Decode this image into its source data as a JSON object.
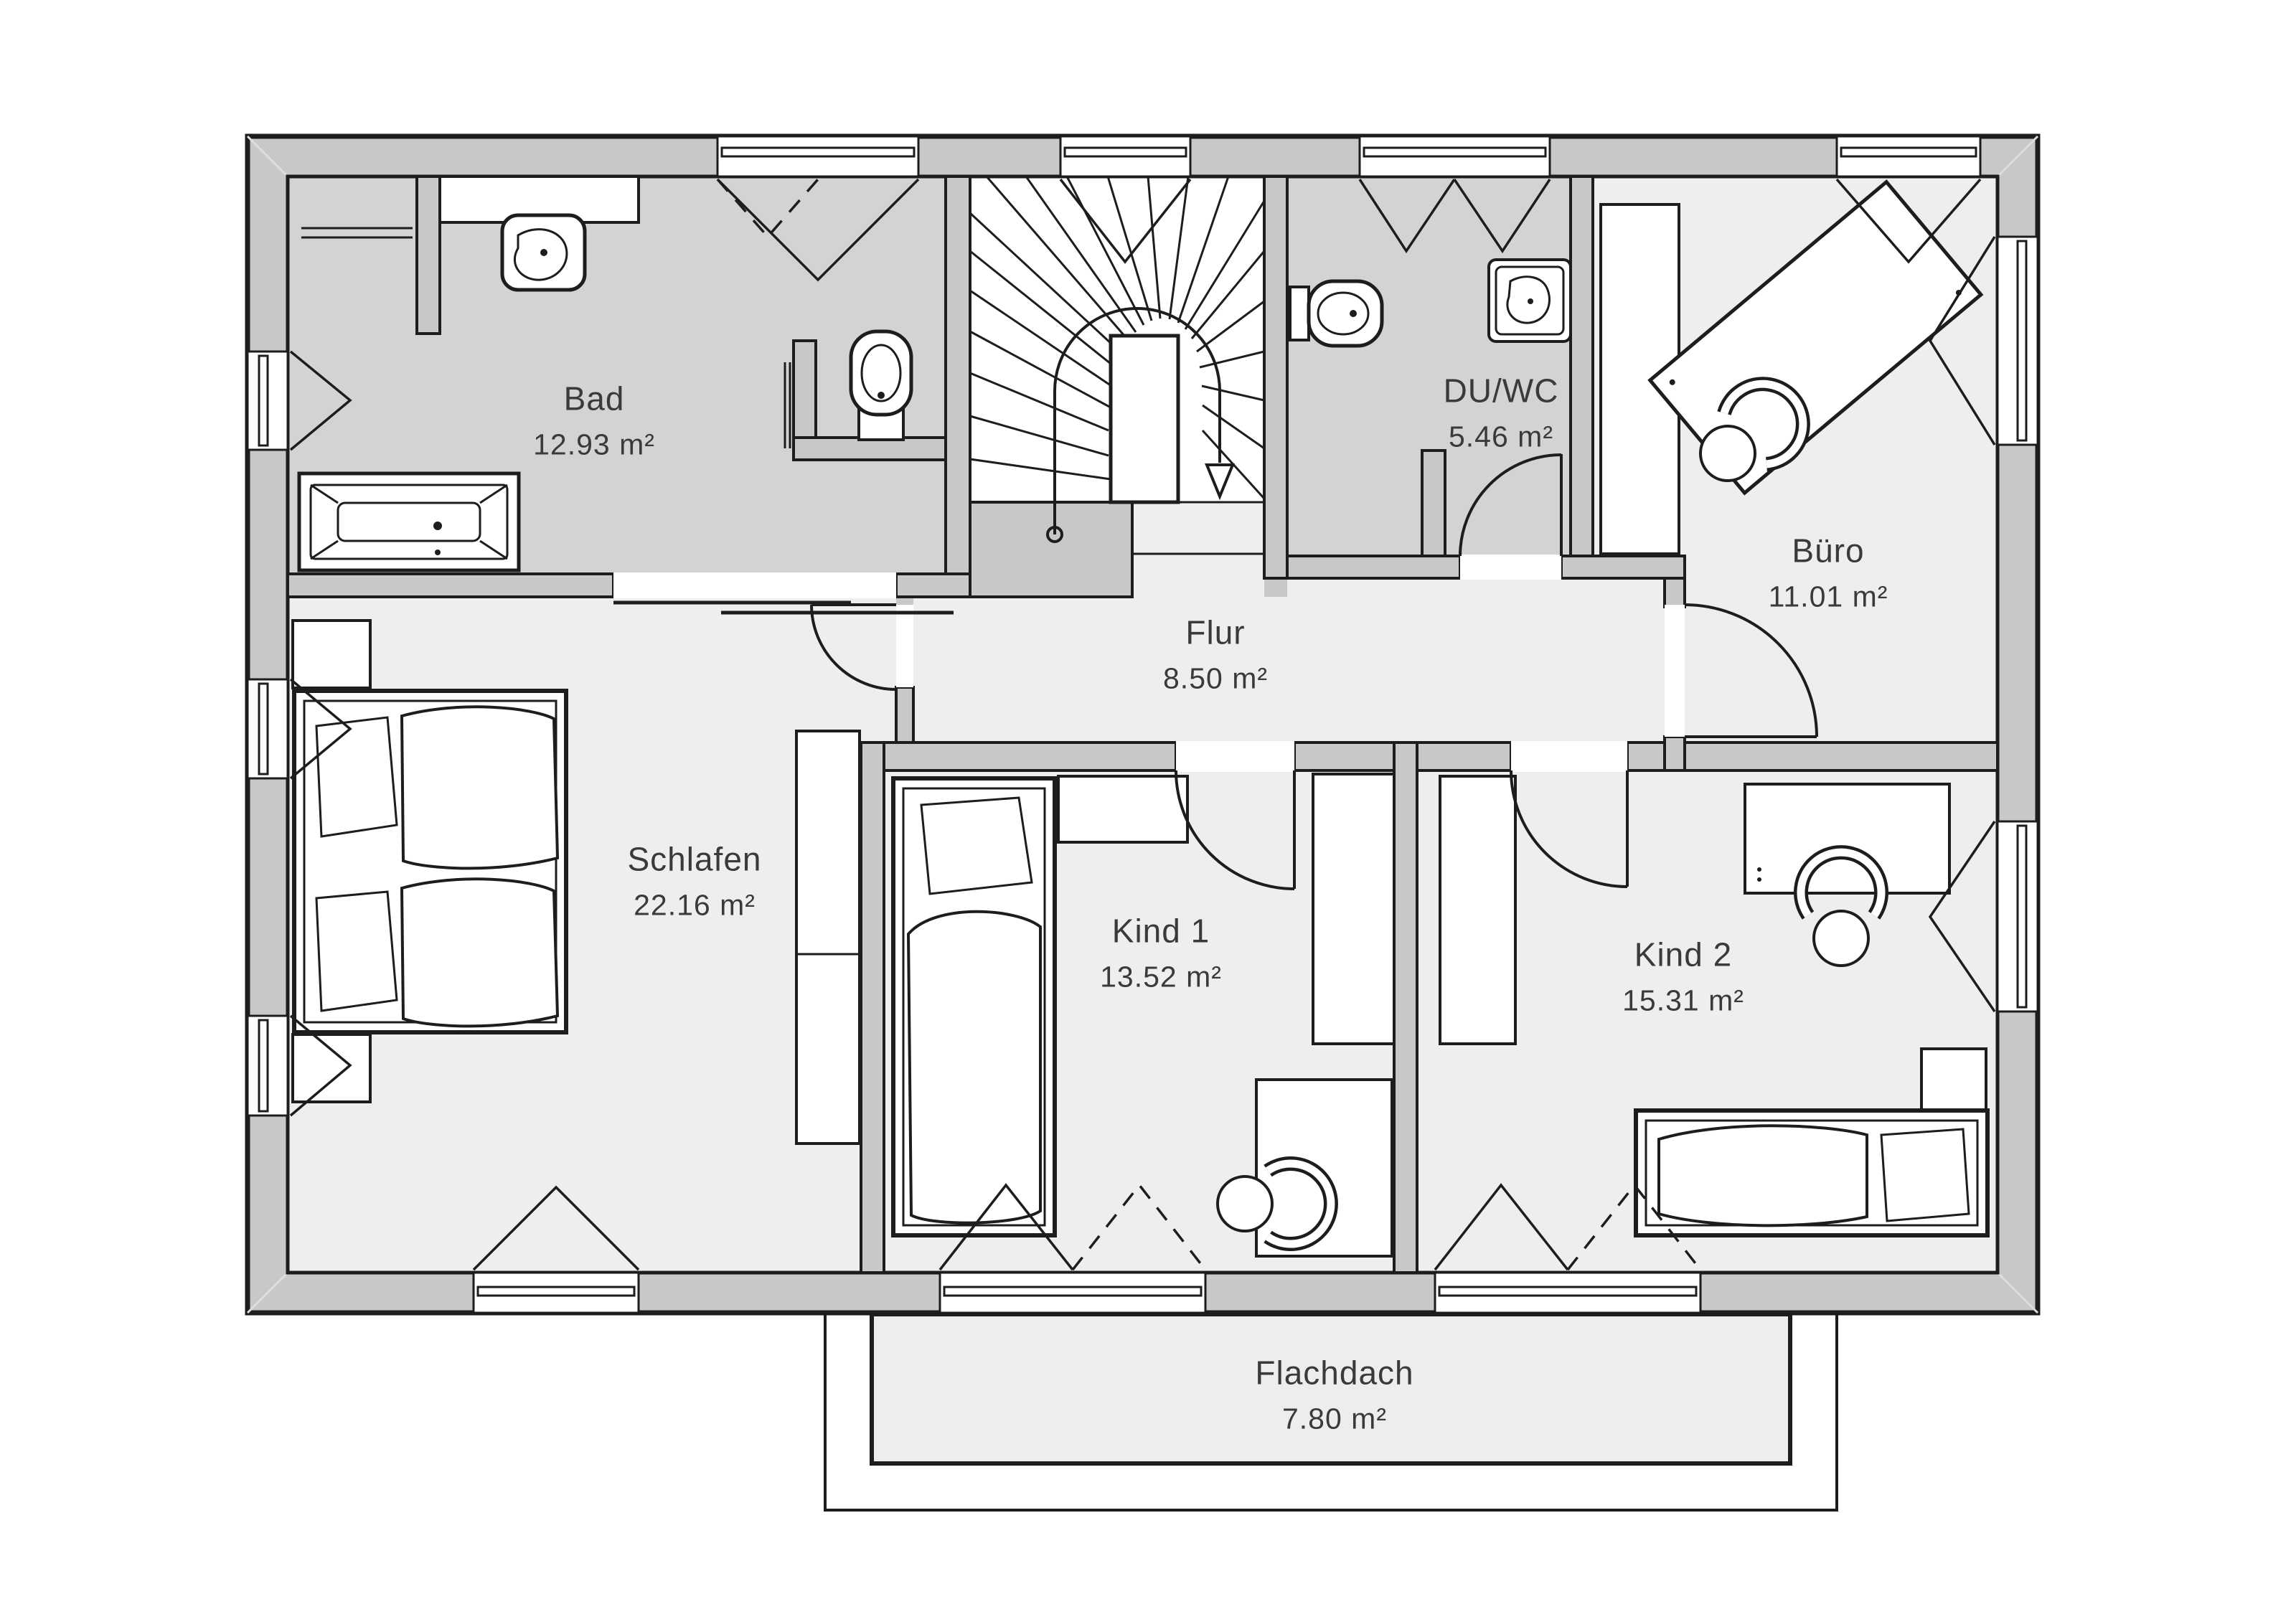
{
  "plan": {
    "type": "floor-plan",
    "language": "de",
    "colors": {
      "background": "#ffffff",
      "wall_fill": "#c8c8c8",
      "wet_room_floor": "#d3d3d3",
      "room_floor": "#eeeeee",
      "stair_floor": "#ffffff",
      "line": "#1d1d1b",
      "label_text": "#3a3a38"
    },
    "rooms": {
      "bad": {
        "label": "Bad",
        "area": "12.93 m²"
      },
      "duwc": {
        "label": "DU/WC",
        "area": "5.46 m²"
      },
      "buero": {
        "label": "Büro",
        "area": "11.01 m²"
      },
      "flur": {
        "label": "Flur",
        "area": "8.50 m²"
      },
      "schlafen": {
        "label": "Schlafen",
        "area": "22.16 m²"
      },
      "kind1": {
        "label": "Kind 1",
        "area": "13.52 m²"
      },
      "kind2": {
        "label": "Kind 2",
        "area": "15.31 m²"
      },
      "flachdach": {
        "label": "Flachdach",
        "area": "7.80 m²"
      }
    },
    "icons": [
      "bathtub-icon",
      "washbasin-icon",
      "toilet-icon",
      "shower-icon",
      "towel-rail-icon",
      "winder-stairs-icon",
      "stair-direction-arrow-icon",
      "double-bed-icon",
      "single-bed-icon",
      "nightstand-icon",
      "wardrobe-icon",
      "desk-icon",
      "office-chair-icon",
      "door-swing-icon",
      "sliding-door-icon",
      "window-icon"
    ]
  }
}
